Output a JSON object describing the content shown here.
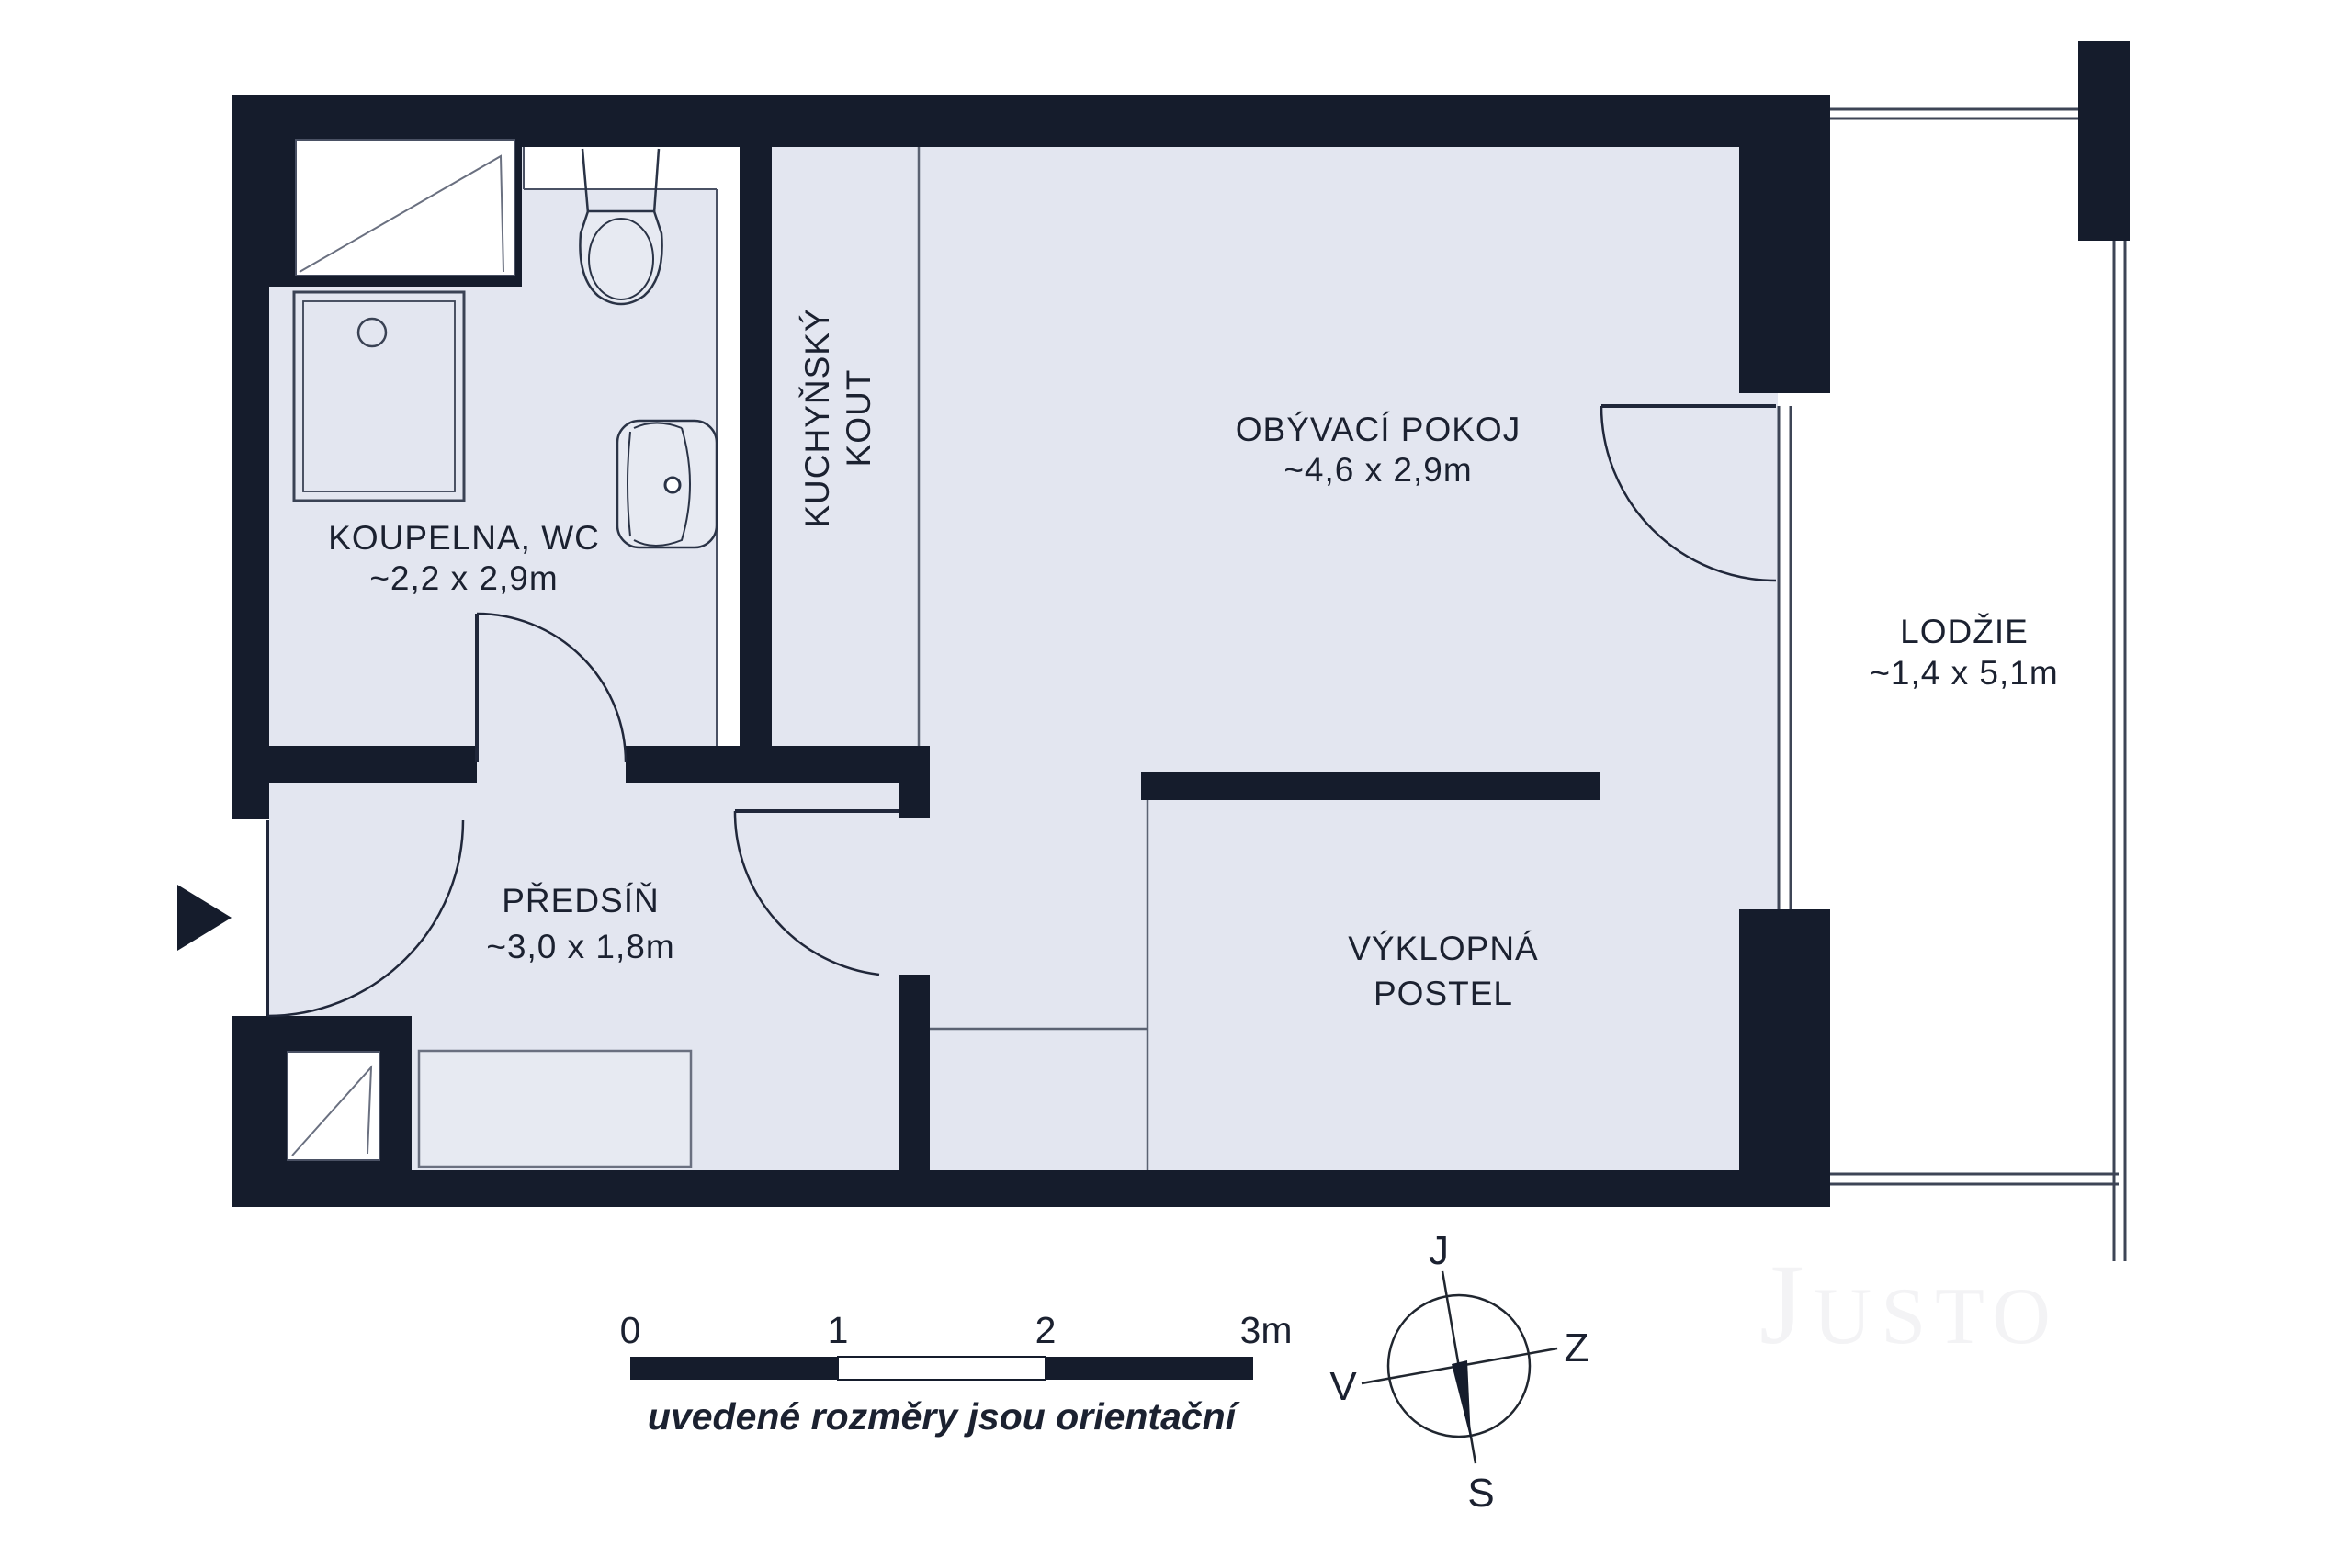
{
  "colors": {
    "wall": "#151c2c",
    "room_fill": "#e3e6f0",
    "thin_line": "#4a5164",
    "white": "#ffffff",
    "watermark": "#f3f3f5"
  },
  "plan": {
    "rooms": [
      {
        "name": "KOUPELNA, WC",
        "dims": "~2,2 x 2,9m"
      },
      {
        "name": "KUCHYŇSKÝ",
        "name2": "KOUT"
      },
      {
        "name": "OBÝVACÍ POKOJ",
        "dims": "~4,6 x 2,9m"
      },
      {
        "name": "PŘEDSÍŇ",
        "dims": "~3,0 x 1,8m"
      },
      {
        "name": "VÝKLOPNÁ",
        "name2": "POSTEL"
      },
      {
        "name": "LODŽIE",
        "dims": "~1,4 x 5,1m"
      }
    ]
  },
  "scale_bar": {
    "labels": [
      "0",
      "1",
      "2",
      "3m"
    ],
    "caption": "uvedené rozměry jsou orientační"
  },
  "compass": {
    "top": "J",
    "right": "Z",
    "bottom": "S",
    "left": "V"
  },
  "watermark": "Justo"
}
